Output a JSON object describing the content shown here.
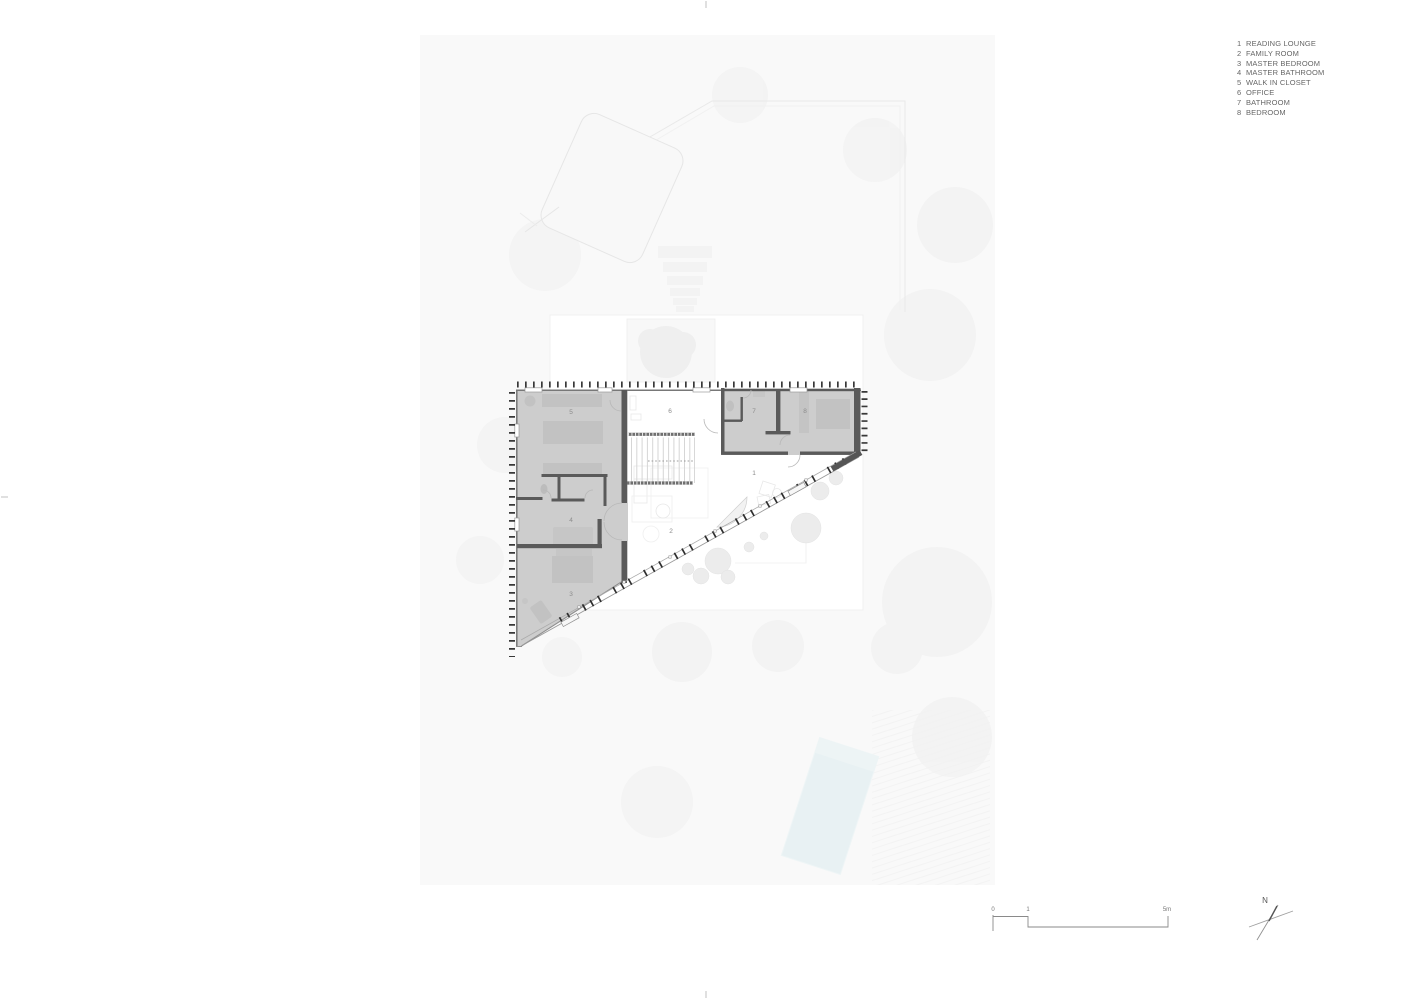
{
  "legend": {
    "items": [
      {
        "number": "1",
        "label": "READING LOUNGE"
      },
      {
        "number": "2",
        "label": "FAMILY ROOM"
      },
      {
        "number": "3",
        "label": "MASTER BEDROOM"
      },
      {
        "number": "4",
        "label": "MASTER BATHROOM"
      },
      {
        "number": "5",
        "label": "WALK IN CLOSET"
      },
      {
        "number": "6",
        "label": "OFFICE"
      },
      {
        "number": "7",
        "label": "BATHROOM"
      },
      {
        "number": "8",
        "label": "BEDROOM"
      }
    ]
  },
  "plan": {
    "room_numbers": {
      "r1": "1",
      "r2": "2",
      "r3": "3",
      "r4": "4",
      "r5": "5",
      "r6": "6",
      "r7": "7",
      "r8": "8"
    }
  },
  "scale_bar": {
    "tick_0": "0",
    "tick_1": "1",
    "tick_5": "5m"
  },
  "compass": {
    "north_label": "N"
  },
  "colors": {
    "site_ground": "#f9f9f9",
    "shaded_floor": "#cdcdcd",
    "wall": "#5a5a5a",
    "hatch_tick": "#383838",
    "furniture": "#c2c2c2",
    "pool_water": "#e8f1f3",
    "label_text": "#8c8c8c",
    "legend_text": "#666666"
  }
}
